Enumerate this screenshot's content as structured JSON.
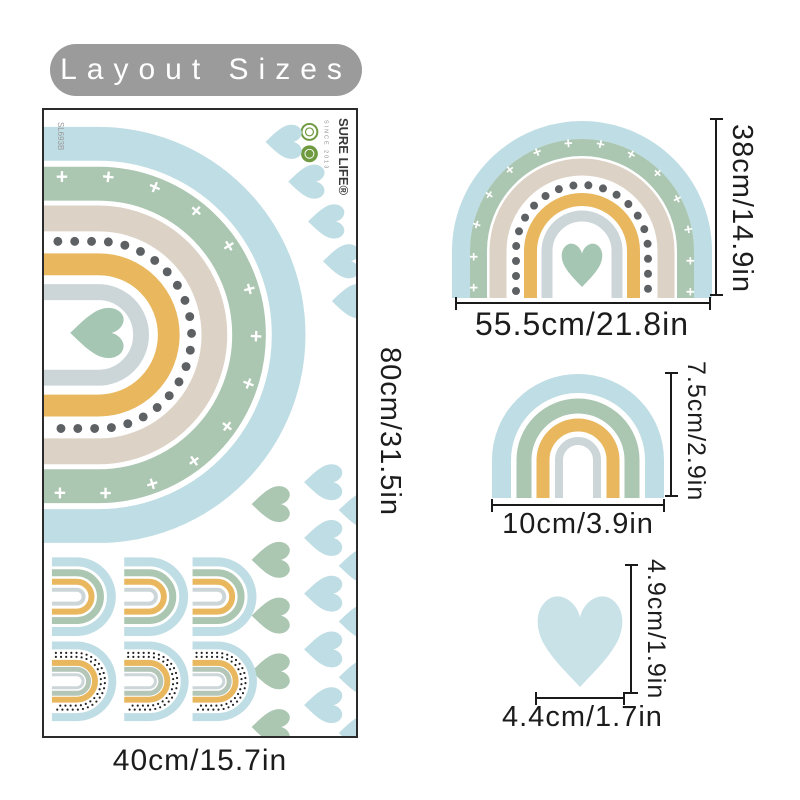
{
  "title": "Layout Sizes",
  "sheet": {
    "sku": "SL693B",
    "brand": "SURE LIFE®",
    "brand_since": "SINCE 2013",
    "width_label": "40cm/15.7in",
    "height_label": "80cm/31.5in"
  },
  "items": {
    "rainbow_large": {
      "width_label": "55.5cm/21.8in",
      "height_label": "38cm/14.9in"
    },
    "rainbow_small": {
      "width_label": "10cm/3.9in",
      "height_label": "7.5cm/2.9in"
    },
    "heart": {
      "width_label": "4.4cm/1.7in",
      "height_label": "4.9cm/1.9in"
    }
  },
  "decor": {
    "plus_row": "+ + + + + + + + + + + + + + + +"
  },
  "colors": {
    "blue": "#bfdde4",
    "blue_light": "#c9e2e8",
    "green": "#abc6b1",
    "green_soft": "#b3c6b8",
    "heart_green": "#a5c6b3",
    "beige": "#ddd2c6",
    "yellow": "#e9b75e",
    "gray_blue": "#ccd6d9",
    "dot_gray": "#5e6164",
    "badge_bg": "#9b9b9b",
    "line": "#1a1a1a",
    "text": "#1c1c1c",
    "logo_green": "#6f9a3f",
    "logo_olive": "#8f7d36"
  }
}
